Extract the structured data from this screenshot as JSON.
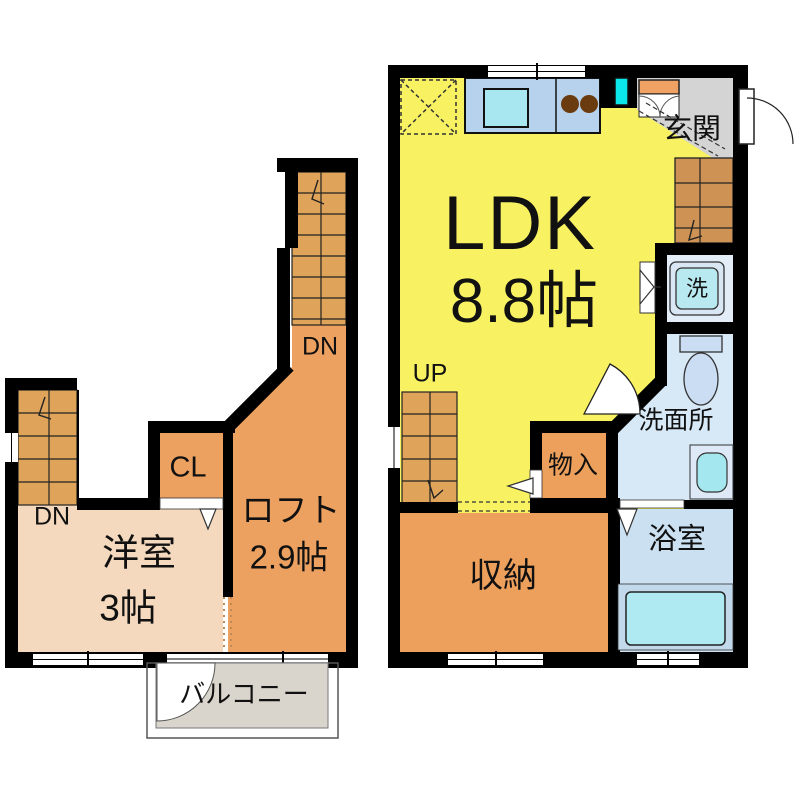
{
  "plan": {
    "title": "apartment-floorplan",
    "labels": {
      "ldk": "LDK",
      "ldk_area": "8.8帖",
      "genkan": "玄関",
      "washer": "洗",
      "senmenjo": "洗面所",
      "yokushitsu": "浴室",
      "monoire": "物入",
      "shunou": "収納",
      "up": "UP",
      "dn_upper": "DN",
      "dn_lower": "DN",
      "cl": "CL",
      "loft": "ロフト",
      "loft_area": "2.9帖",
      "youshitsu": "洋室",
      "youshitsu_area": "3帖",
      "balcony": "バルコニー"
    },
    "colors": {
      "ldk_fill": "#F8F262",
      "genkan_fill": "#D4D4D4",
      "orange_room_fill": "#ECA05C",
      "loft_fill": "#EDA160",
      "stair_fill": "#DFA35A",
      "stair_fill_dark": "#CE9254",
      "western_room_fill": "#F4D9BE",
      "balcony_fill": "#DAD5CC",
      "washroom_fill": "#D7E8F6",
      "bathroom_fill": "#CBE0F1",
      "washer_room_fill": "#E3EDF8",
      "washer_fill": "#B9E9F0",
      "tub_fill": "#AFEAF3",
      "tub_deck_fill": "#C2D8EB",
      "toilet_fill": "#CBDDF3",
      "counter_fill": "#B7D2EC",
      "kitchen_sink_fill": "#A9E7F0",
      "vanity_sink_fill": "#A5E7EE",
      "burner_fill": "#6B3B10",
      "shoe_cabinet_fill": "#EFA263",
      "cyan_window": "#0AE6E9",
      "wall": "#000000"
    }
  }
}
